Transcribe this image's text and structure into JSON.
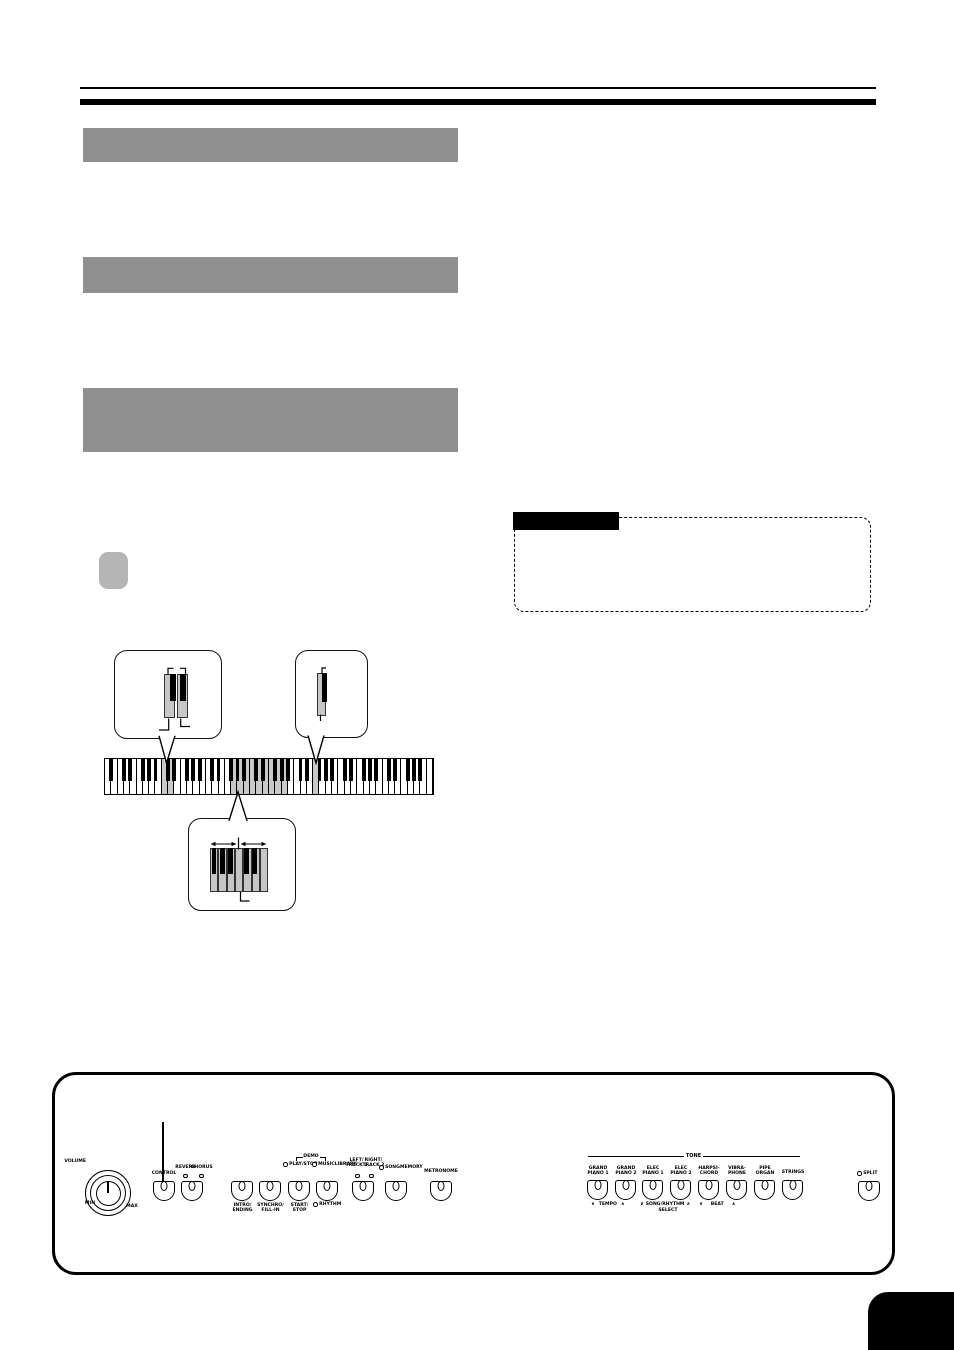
{
  "colors": {
    "heading_bar_gray": "#8f8f8f",
    "step_badge_gray": "#b5b5b5",
    "key_highlight": "#c9c9c9",
    "callout_key_gray": "#c6c6c6",
    "ink": "#000000"
  },
  "keyboard": {
    "white_key_count": 52,
    "highlight_keys": [
      [
        9,
        10
      ],
      [
        20,
        28
      ],
      [
        33,
        33
      ]
    ],
    "mini": {
      "keys": 7,
      "black_offsets": [
        1.7,
        10,
        18.3,
        34.3,
        42
      ]
    }
  },
  "panel": {
    "volume_label": "VOLUME",
    "min_label": "MIN",
    "max_label": "MAX",
    "control_label": "CONTROL",
    "reverb_label": "REVERB",
    "chorus_label": "CHORUS",
    "demo_label": "DEMO",
    "play_stop": {
      "l1": "PLAY/",
      "l2": "STOP"
    },
    "music_library": {
      "l1": "MUSIC",
      "l2": "LIBRARY"
    },
    "rhythm_label": "RHYTHM",
    "intro": {
      "l1": "INTRO/",
      "l2": "ENDING"
    },
    "synchro": {
      "l1": "SYNCHRO/",
      "l2": "FILL-IN"
    },
    "start_stop": {
      "l1": "START/",
      "l2": "STOP"
    },
    "left_track": {
      "l1": "LEFT/",
      "l2": "TRACK 1"
    },
    "right_track": {
      "l1": "RIGHT/",
      "l2": "TRACK 2"
    },
    "song_memory": {
      "l1": "SONG",
      "l2": "MEMORY"
    },
    "metronome_label": "METRONOME",
    "tone_label": "TONE",
    "tones": [
      {
        "l1": "GRAND",
        "l2": "PIANO 1"
      },
      {
        "l1": "GRAND",
        "l2": "PIANO 2"
      },
      {
        "l1": "ELEC",
        "l2": "PIANO 1"
      },
      {
        "l1": "ELEC",
        "l2": "PIANO 2"
      },
      {
        "l1": "HARPSI-",
        "l2": "CHORD"
      },
      {
        "l1": "VIBRA-",
        "l2": "PHONE"
      },
      {
        "l1": "PIPE",
        "l2": "ORGAN"
      },
      {
        "l1": "STRINGS",
        "l2": ""
      }
    ],
    "tempo_label": "TEMPO",
    "song_rhythm_label": "SONG/RHYTHM",
    "select_label": "SELECT",
    "beat_label": "BEAT",
    "arrow_down": "∨",
    "arrow_up": "∧",
    "split_label": "SPLIT"
  }
}
